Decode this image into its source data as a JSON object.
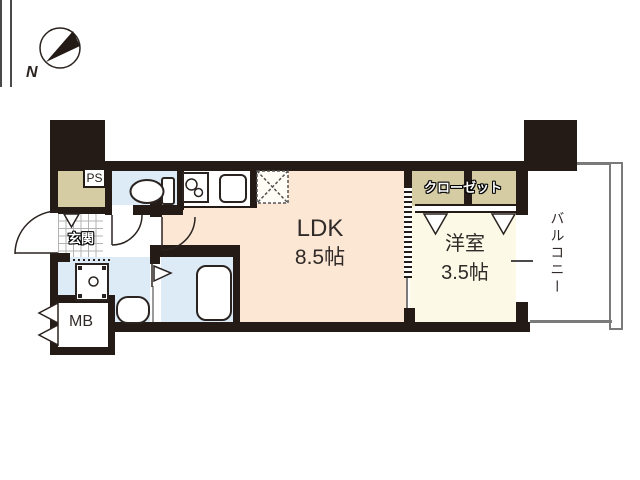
{
  "compass": {
    "north_label": "N"
  },
  "rooms": {
    "ldk": {
      "label": "LDK",
      "size": "8.5帖"
    },
    "western_room": {
      "label": "洋室",
      "size": "3.5帖"
    },
    "closet": {
      "label": "クローゼット"
    },
    "balcony": {
      "label": "バルコニー"
    },
    "entrance": {
      "label": "玄関"
    },
    "pipe_space": {
      "label": "PS"
    },
    "meter_box": {
      "label": "MB"
    }
  },
  "icons": {
    "compass": "compass-north-icon",
    "toilet": "toilet-icon",
    "stove": "stove-burner-icon",
    "kitchen_sink": "kitchen-sink-icon",
    "refrigerator_space": "refrigerator-space-icon",
    "washing_machine": "washing-machine-icon",
    "washbasin": "washbasin-icon",
    "bathtub": "bathtub-icon",
    "bath_door": "bath-door-flag-icon",
    "entrance_door": "door-swing-icon",
    "toilet_door": "door-swing-icon",
    "ldk_door": "door-swing-icon",
    "closet_doors": "closet-door-v-icon",
    "entrance_cabinet_door": "closet-door-v-icon",
    "meter_box_doors": "meter-box-door-icon",
    "sliding_door": "sliding-door-icon",
    "window": "window-icon"
  },
  "colors": {
    "wall": "#241b17",
    "ldk_floor": "#fbe7d4",
    "western_room_floor": "#fdf9e7",
    "closet_fill": "#d5cca3",
    "water_area_fill": "#dcebf5",
    "balcony_line": "#7a7a7a",
    "text": "#302a28"
  }
}
